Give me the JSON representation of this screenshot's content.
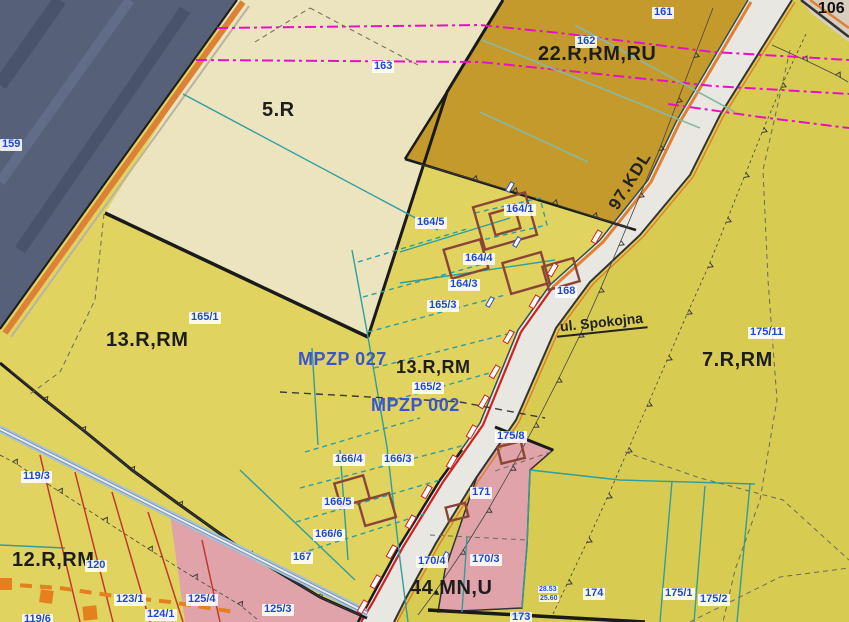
{
  "zones": {
    "z5": "5.R",
    "z22": "22.R,RM,RU",
    "z13_left": "13.R,RM",
    "z13_center": "13.R,RM",
    "z7": "7.R,RM",
    "z12": "12.R,RM",
    "z44": "44.MN,U"
  },
  "roads": {
    "kdl": "97.KDL",
    "street": "ul. Spokojna",
    "corner": "106"
  },
  "plans": {
    "plan_a": "MPZP 027",
    "plan_b": "MPZP 002"
  },
  "parcels": {
    "p159": "159",
    "p161": "161",
    "p162": "162",
    "p163": "163",
    "p164_1": "164/1",
    "p164_3": "164/3",
    "p164_4": "164/4",
    "p164_5": "164/5",
    "p165_1": "165/1",
    "p165_2": "165/2",
    "p165_3": "165/3",
    "p166_3": "166/3",
    "p166_4": "166/4",
    "p166_5": "166/5",
    "p166_6": "166/6",
    "p167": "167",
    "p168": "168",
    "p170_3": "170/3",
    "p170_4": "170/4",
    "p171": "171",
    "p173": "173",
    "p174": "174",
    "p175_1": "175/1",
    "p175_2": "175/2",
    "p175_8": "175/8",
    "p175_11": "175/11",
    "p119_3": "119/3",
    "p119_6": "119/6",
    "p120": "120",
    "p123_1": "123/1",
    "p124_1": "124/1",
    "p125_3": "125/3",
    "p125_4": "125/4"
  },
  "measurements": {
    "m1": "28.53",
    "m2": "25.60"
  },
  "colors": {
    "yellow_main": "#e0d360",
    "yellow_right": "#d8cb52",
    "cream": "#ebe4be",
    "ochre": "#c49a2c",
    "pink": "#dfa3a9",
    "forest": "#566179",
    "road_fill": "#e9e7e2",
    "teal_line": "#2f9e9e",
    "magenta_line": "#e511c9",
    "orange_line": "#e08030",
    "building_line": "#8a4536",
    "parcel_label_blue": "#1b49cf"
  }
}
